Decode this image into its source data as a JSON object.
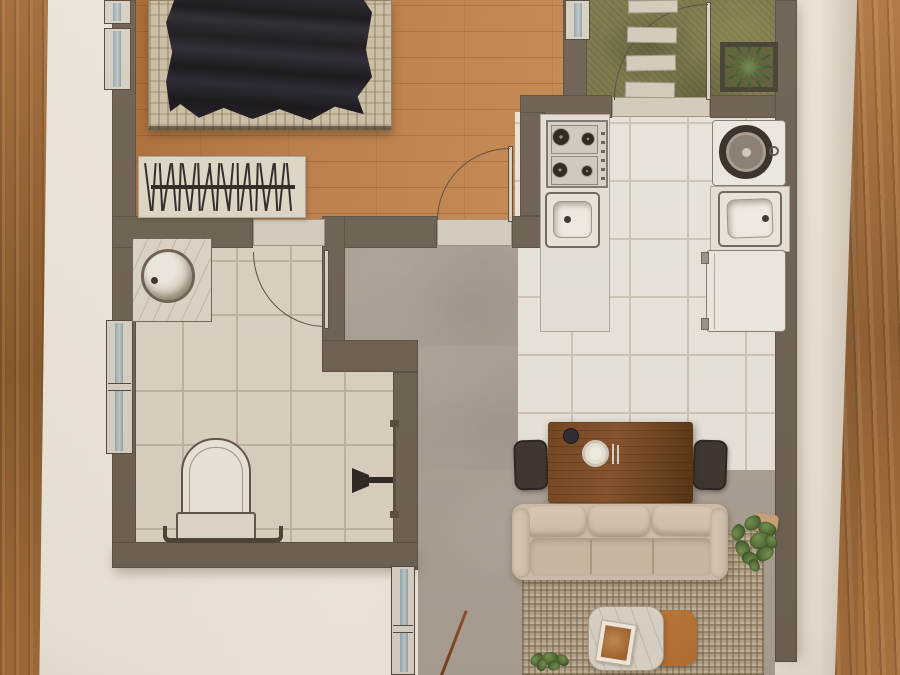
{
  "photo": {
    "background": "wooden table surface visible on left and right edges",
    "sheet": "white paper with printed top-view apartment floor plan"
  },
  "plan": {
    "rooms": [
      {
        "id": "bedroom",
        "floor": "wood planks",
        "items": [
          "double bed with dark duvet",
          "striped barcode rug"
        ],
        "windows": 3
      },
      {
        "id": "bathroom",
        "floor": "beige ceramic tiles",
        "items": [
          "round basin vanity",
          "wall-hung toilet",
          "towel rail",
          "shower fixture with glass panel"
        ],
        "windows": 1
      },
      {
        "id": "kitchen",
        "floor": "white tiles",
        "items": [
          "4-burner gas stove",
          "prep sink",
          "washing machine",
          "kitchen sink",
          "fridge"
        ]
      },
      {
        "id": "hallway",
        "floor": "concrete screed",
        "items": []
      },
      {
        "id": "living-dining",
        "floor": "concrete screed",
        "items": [
          "dining table with plate, bowl and cutlery",
          "two dark chairs",
          "three-seat beige sofa",
          "woven area rug",
          "marble + orange coffee table with book",
          "broom",
          "potted plants"
        ],
        "windows": 1
      },
      {
        "id": "entry-patio",
        "floor": "grass",
        "items": [
          "stepping stones",
          "square planter with agave",
          "entry door"
        ]
      }
    ],
    "door_count": 3,
    "window_count": 5
  },
  "palette": {
    "wood-left": "#a06a39",
    "wood-left-dark": "#835527",
    "wood-right": "#ae7440",
    "wood-right-dark": "#8d5c2f",
    "wall": "#6b5f52",
    "wall-edge": "#50463b",
    "fixture-line": "#564a3d",
    "bedroom-floor": "#b97b46",
    "bedroom-floor-dark": "#a3662f",
    "bed-base": "#c8bca2",
    "rug-bed": "#ddd6c7",
    "rug-stroke": "#2c2723",
    "bath-tile": "#d8d0c2",
    "bath-grout": "#bcb1a0",
    "kitchen-tile": "#e8e3da",
    "kitchen-grout": "#ccc4b7",
    "concrete": "#a89e93",
    "grass": "#7a7749",
    "stone": "#d1cabb",
    "counter": "#e4dfd6",
    "frame": "#d6cfc2",
    "threshold": "#d2cbbd",
    "table-wood": "#71431f",
    "table-wood-dark": "#53300f",
    "chair": "#3b342d",
    "sofa": "#cdbfac",
    "sofa-hi": "#d9cbb8",
    "rug-living": "#b2a38a",
    "marble": "#dad3c6",
    "orange-table": "#b26d31",
    "plant": "#5d7a40"
  },
  "decor": {
    "bed_rug_stroke_tilts": [
      -7,
      4,
      -3,
      9,
      -5,
      2,
      -8,
      6,
      -2,
      10,
      -6,
      3,
      -9,
      5,
      -1,
      8,
      -4,
      2,
      -7,
      9,
      -3,
      6,
      -5
    ],
    "stepping_stones": [
      {
        "x": 3,
        "y": 0,
        "w": 50,
        "h": 13,
        "r": -1
      },
      {
        "x": 2,
        "y": 27,
        "w": 50,
        "h": 16,
        "r": 1
      },
      {
        "x": 1,
        "y": 55,
        "w": 50,
        "h": 16,
        "r": -1
      },
      {
        "x": 0,
        "y": 82,
        "w": 50,
        "h": 16,
        "r": 1
      }
    ],
    "agave_leaf_angles": [
      0,
      30,
      60,
      90,
      120,
      150,
      180,
      210,
      240,
      270,
      300,
      330
    ],
    "plant_right_leaves": [
      {
        "x": 16,
        "y": 0,
        "s": 17,
        "r": -15
      },
      {
        "x": 30,
        "y": 6,
        "s": 18,
        "r": 35
      },
      {
        "x": 2,
        "y": 10,
        "s": 16,
        "r": -55
      },
      {
        "x": 22,
        "y": 16,
        "s": 21,
        "r": 5
      },
      {
        "x": 6,
        "y": 26,
        "s": 17,
        "r": -100
      },
      {
        "x": 28,
        "y": 30,
        "s": 18,
        "r": 160
      },
      {
        "x": 14,
        "y": 36,
        "s": 16,
        "r": 210
      },
      {
        "x": 36,
        "y": 20,
        "s": 14,
        "r": 75
      },
      {
        "x": 20,
        "y": 44,
        "s": 13,
        "r": 250
      }
    ],
    "plant_bottom_leaves": [
      {
        "x": 2,
        "y": 2,
        "s": 14,
        "r": -30
      },
      {
        "x": 14,
        "y": 0,
        "s": 16,
        "r": 15
      },
      {
        "x": 28,
        "y": 3,
        "s": 13,
        "r": 60
      },
      {
        "x": 8,
        "y": 8,
        "s": 12,
        "r": 120
      },
      {
        "x": 20,
        "y": 9,
        "s": 12,
        "r": 190
      }
    ],
    "stove_burners": [
      {
        "x": 561,
        "y": 137,
        "r": 9
      },
      {
        "x": 588,
        "y": 139,
        "r": 7
      },
      {
        "x": 560,
        "y": 170,
        "r": 8
      },
      {
        "x": 587,
        "y": 171,
        "r": 6
      }
    ]
  }
}
